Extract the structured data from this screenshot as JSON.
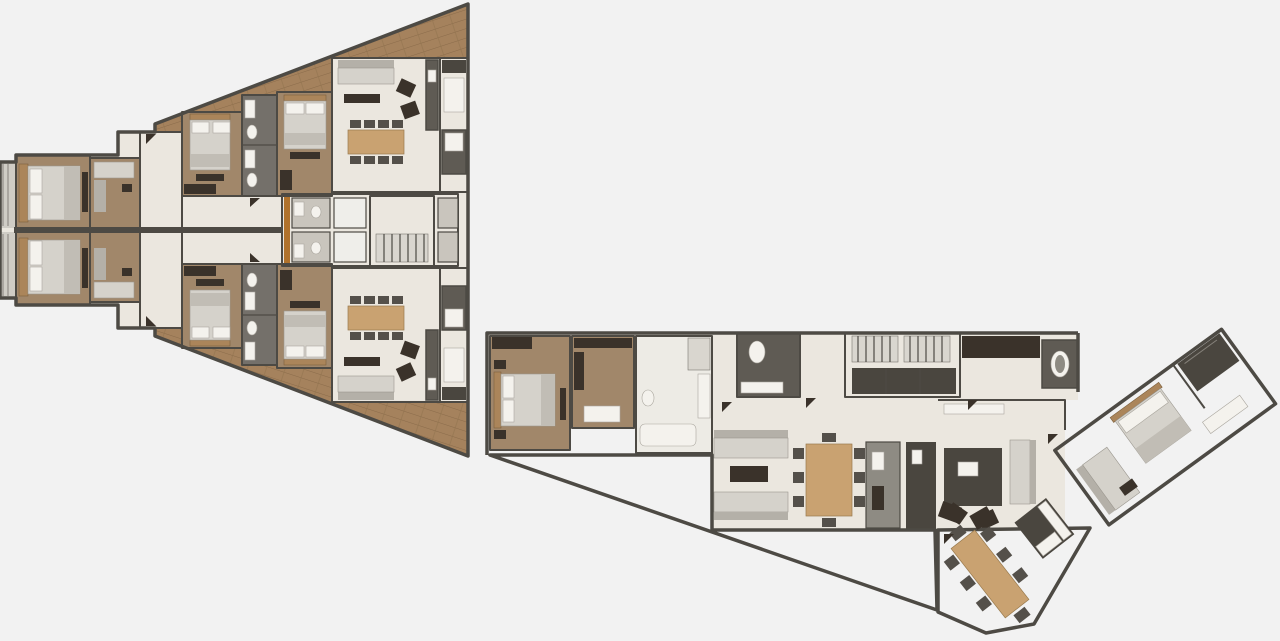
{
  "scene": {
    "title": "3D architectural floor plan — residential level with two wings",
    "background": "#f2f2f2"
  },
  "palette": {
    "wall": "#4d4a44",
    "wall_light": "#8f8c84",
    "marble_floor": "#ebe7df",
    "bedroom_floor": "#a1876a",
    "deck_wood": "#a5825d",
    "deck_seam": "#8a6b4a",
    "bath_floor": "#74706a",
    "core_dark": "#57544d",
    "dark_room": "#5f5b54",
    "furniture_light": "#d5d2cb",
    "furniture_white": "#f4f2ed",
    "table_wood": "#c9a271",
    "chair_dark": "#54504a",
    "accent_brown": "#3a322a",
    "elevator_door": "#b0722c"
  },
  "west_wing": {
    "label": "west wing — two mirrored duplex units",
    "upper_unit_rooms": [
      "balcony",
      "bedroom 1",
      "dressing room",
      "entry hall",
      "bedroom 2",
      "bathroom",
      "bedroom 3",
      "living–dining room",
      "kitchen"
    ],
    "lower_unit_rooms": [
      "balcony",
      "bedroom 1",
      "dressing room",
      "entry hall",
      "bedroom 2",
      "bathroom",
      "bedroom 3",
      "living–dining room",
      "kitchen"
    ],
    "core_rooms": [
      "bathroom",
      "bathroom",
      "elevator",
      "elevator",
      "staircase",
      "bathroom",
      "bathroom"
    ],
    "terrace": "wood deck terrace along sloped facade"
  },
  "east_wing": {
    "label": "east wing — penthouse unit",
    "rooms": [
      "master bedroom",
      "walk-in closet",
      "master bathroom",
      "powder room",
      "staircase",
      "entry hall with closets",
      "powder bath",
      "living room",
      "dining room",
      "kitchen",
      "family sitting area",
      "breakfast dining room",
      "kitchenette",
      "guest suite (angled wing)",
      "wardrobe closet"
    ],
    "terrace": "triangular wood deck terrace"
  }
}
